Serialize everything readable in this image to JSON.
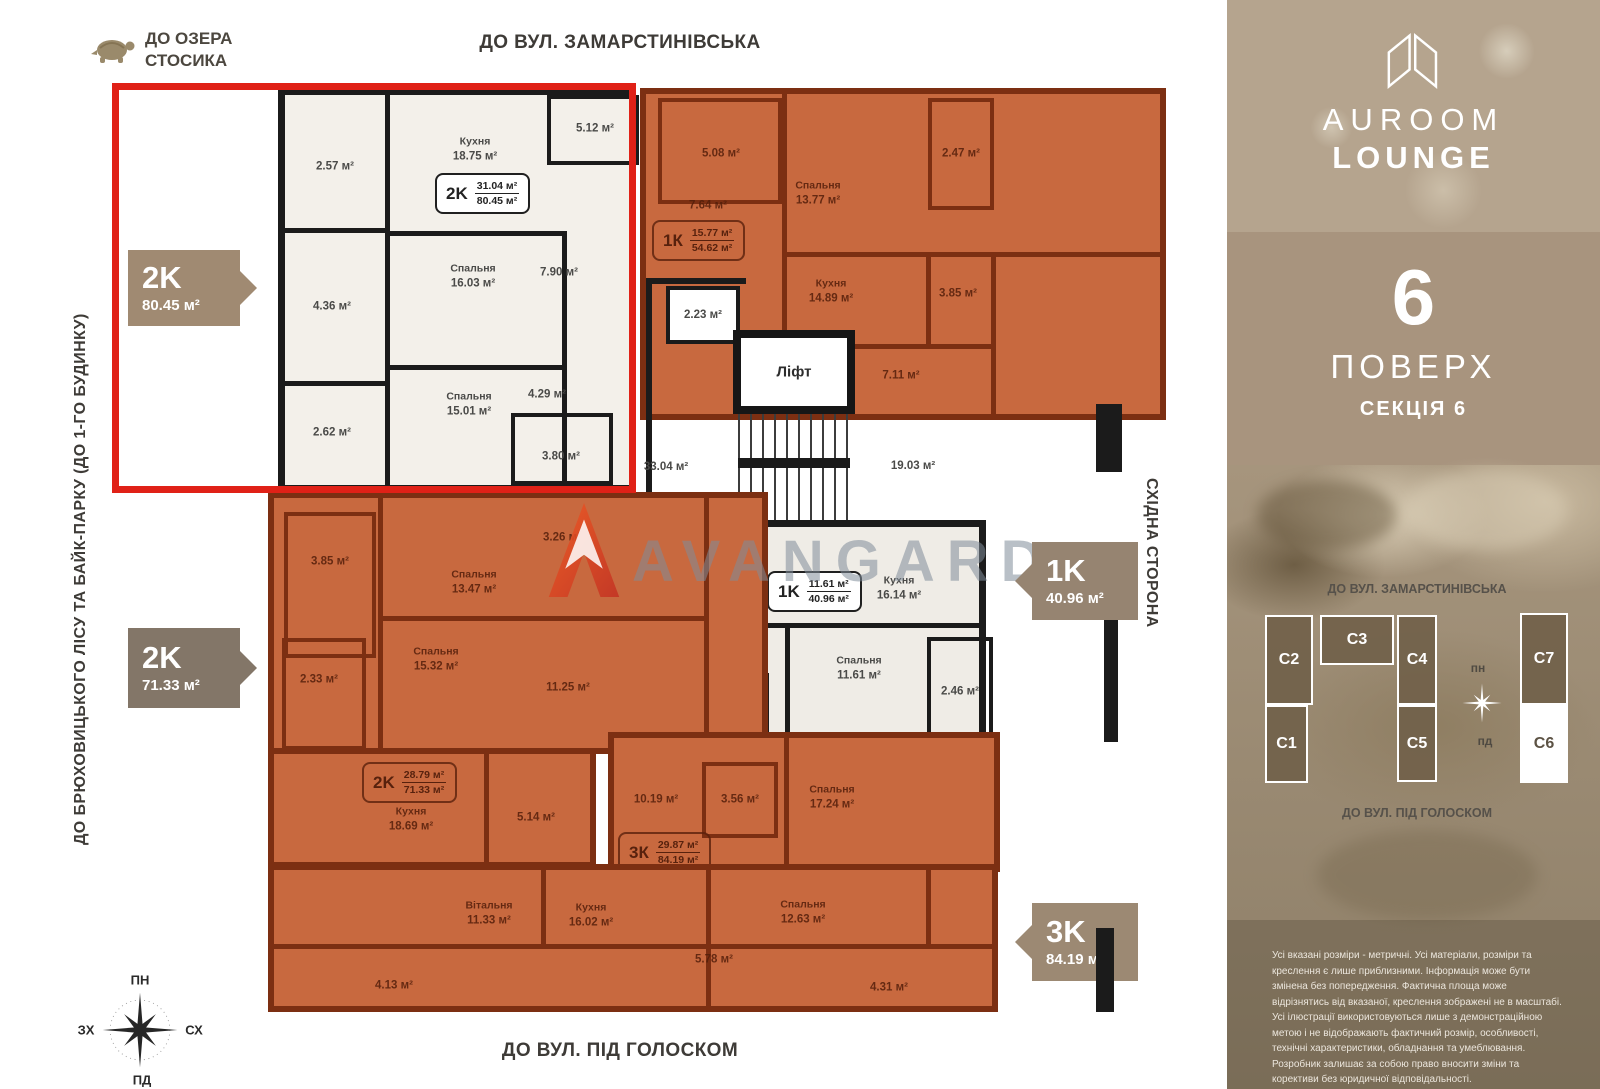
{
  "colors": {
    "orange": "#c8693f",
    "orange_wall": "#7c2f12",
    "white_apt": "#f3f0ea",
    "wall_dark": "#1b1b1b",
    "red_frame": "#e02117",
    "tag_tan": "#a08a72",
    "tag_dark": "#837668",
    "tag_mid": "#968471",
    "sidebar_top": "#b5a48e",
    "sidebar_band": "#a8947e",
    "watermark_gray": "#808c99",
    "avangard_red": "#e0401f"
  },
  "header": {
    "lake_line1": "ДО ОЗЕРА",
    "lake_line2": "СТОСИКА",
    "top_street": "ДО ВУЛ. ЗАМАРСТИНІВСЬКА",
    "left_street": "ДО БРЮХОВИЦЬКОГО ЛІСУ ТА БАЙК-ПАРКУ (ДО 1-ГО БУДИНКУ)",
    "right_side": "СХІДНА СТОРОНА",
    "bottom_street": "ДО ВУЛ. ПІД ГОЛОСКОМ"
  },
  "compass": {
    "n": "ПН",
    "e": "СХ",
    "s": "ПД",
    "w": "ЗХ"
  },
  "watermark": {
    "text": "AVANGARD"
  },
  "tags": {
    "t2k80": {
      "type": "2K",
      "area": "80.45 м²"
    },
    "t2k71": {
      "type": "2K",
      "area": "71.33 м²"
    },
    "t1k54": {
      "type": "1K",
      "area": "54.62 м²"
    },
    "t1k40": {
      "type": "1K",
      "area": "40.96 м²"
    },
    "t3k84": {
      "type": "3K",
      "area": "84.19 м²"
    }
  },
  "apartments": {
    "hl2k": {
      "badge": {
        "type": "2K",
        "living": "31.04 м²",
        "total": "80.45 м²"
      },
      "rooms": [
        {
          "name": "",
          "area": "2.57 м²"
        },
        {
          "name": "Кухня",
          "area": "18.75 м²"
        },
        {
          "name": "",
          "area": "5.12 м²"
        },
        {
          "name": "",
          "area": "4.36 м²"
        },
        {
          "name": "Спальня",
          "area": "16.03 м²"
        },
        {
          "name": "",
          "area": "7.90 м²"
        },
        {
          "name": "",
          "area": "2.62 м²"
        },
        {
          "name": "Спальня",
          "area": "15.01 м²"
        },
        {
          "name": "",
          "area": "4.29 м²"
        },
        {
          "name": "",
          "area": "3.80 м²"
        }
      ]
    },
    "k154": {
      "badge": {
        "type": "1К",
        "living": "15.77 м²",
        "total": "54.62 м²"
      },
      "rooms": [
        {
          "name": "",
          "area": "5.08 м²"
        },
        {
          "name": "Спальня",
          "area": "13.77 м²"
        },
        {
          "name": "",
          "area": "2.47 м²"
        },
        {
          "name": "",
          "area": "7.64 м²"
        },
        {
          "name": "Кухня",
          "area": "14.89 м²"
        },
        {
          "name": "",
          "area": "3.85 м²"
        },
        {
          "name": "",
          "area": "7.11 м²"
        }
      ]
    },
    "core": {
      "room223": "2.23 м²",
      "lift": "Ліфт",
      "hall": "33.04 м²",
      "stairs": "19.03 м²"
    },
    "k140": {
      "badge": {
        "type": "1K",
        "living": "11.61 м²",
        "total": "40.96 м²"
      },
      "rooms": [
        {
          "name": "",
          "area": "2.45 м²"
        },
        {
          "name": "Кухня",
          "area": "16.14 м²"
        },
        {
          "name": "",
          "area": "5.59 м²"
        },
        {
          "name": "Спальня",
          "area": "11.61 м²"
        },
        {
          "name": "",
          "area": "5.16 м²"
        },
        {
          "name": "",
          "area": "2.46 м²"
        }
      ]
    },
    "k271": {
      "badge": {
        "type": "2K",
        "living": "28.79 м²",
        "total": "71.33 м²"
      },
      "rooms": [
        {
          "name": "",
          "area": "3.85 м²"
        },
        {
          "name": "Спальня",
          "area": "13.47 м²"
        },
        {
          "name": "",
          "area": "3.26 м²"
        },
        {
          "name": "",
          "area": "2.33 м²"
        },
        {
          "name": "Спальня",
          "area": "15.32 м²"
        },
        {
          "name": "",
          "area": "11.25 м²"
        },
        {
          "name": "Кухня",
          "area": "18.69 м²"
        },
        {
          "name": "",
          "area": "5.14 м²"
        }
      ]
    },
    "k384": {
      "badge": {
        "type": "3К",
        "living": "29.87 м²",
        "total": "84.19 м²"
      },
      "rooms": [
        {
          "name": "",
          "area": "10.19 м²"
        },
        {
          "name": "",
          "area": "3.56 м²"
        },
        {
          "name": "Спальня",
          "area": "17.24 м²"
        },
        {
          "name": "Вітальня",
          "area": "11.33 м²"
        },
        {
          "name": "Кухня",
          "area": "16.02 м²"
        },
        {
          "name": "Спальня",
          "area": "12.63 м²"
        },
        {
          "name": "",
          "area": "5.78 м²"
        },
        {
          "name": "",
          "area": "4.13 м²"
        },
        {
          "name": "",
          "area": "4.31 м²"
        }
      ]
    }
  },
  "sidebar": {
    "brand_line1": "AUROOM",
    "brand_line2": "LOUNGE",
    "floor_number": "6",
    "floor_label": "ПОВЕРХ",
    "section_label": "СЕКЦІЯ 6",
    "map": {
      "top": "ДО ВУЛ. ЗАМАРСТИНІВСЬКА",
      "bottom": "ДО ВУЛ. ПІД ГОЛОСКОМ",
      "c1": "С1",
      "c2": "С2",
      "c3": "С3",
      "c4": "С4",
      "c5": "С5",
      "c6": "С6",
      "c7": "С7",
      "compass_n": "пн",
      "compass_s": "пд"
    },
    "disclaimer": "Усі вказані розміри - метричні. Усі матеріали, розміри та креслення є лише приблизними. Інформація може бути змінена без попередження. Фактична площа може відрізнятись від вказаної, креслення зображені не в масштабі. Усі ілюстрації використовуються лише з демонстраційною метою і не відображають фактичний розмір, особливості, технічні характеристики, обладнання та умеблювання. Розробник залишає за собою право вносити зміни та корективи без юридичної відповідальності."
  }
}
